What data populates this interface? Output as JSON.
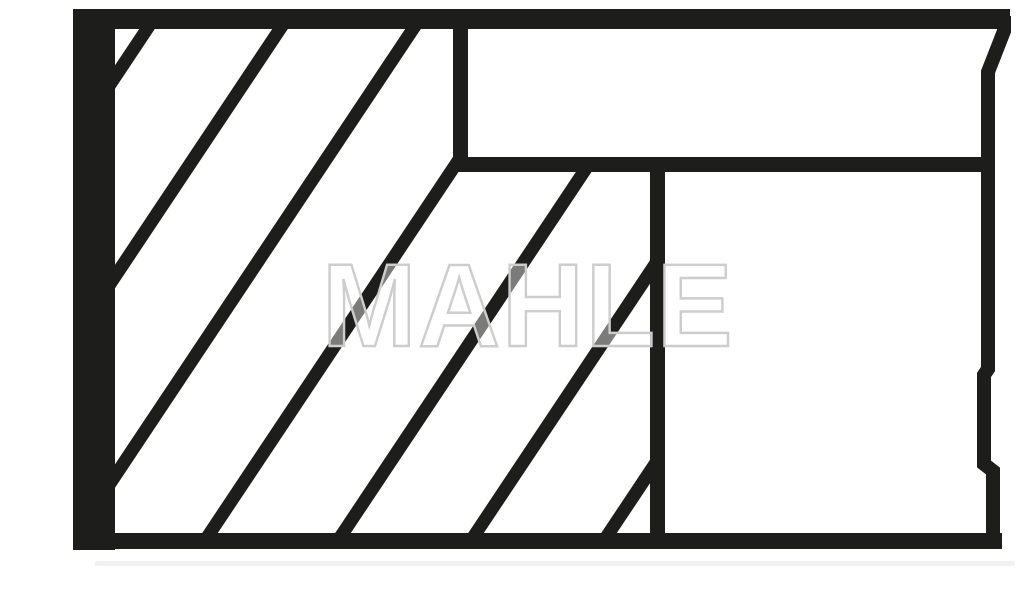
{
  "image": {
    "title": "Piston ring set cross-section line drawing",
    "background_color": "#ffffff",
    "line_color": "#1d1d1b",
    "shadow_color": "#f0f0f0"
  },
  "watermark": {
    "text": "MAHLE",
    "outline_color": "#cdcdcd",
    "fill_color": "rgba(255,255,255,0.42)"
  },
  "drawing": {
    "canvas": {
      "width": 1024,
      "height": 606
    },
    "bars": [
      {
        "name": "top-border",
        "x": 73,
        "y": 9,
        "w": 937,
        "h": 20
      },
      {
        "name": "left-border",
        "x": 73,
        "y": 9,
        "w": 42,
        "h": 541
      },
      {
        "name": "bottom-border",
        "x": 73,
        "y": 533,
        "w": 929,
        "h": 16
      },
      {
        "name": "groove-divider-horizontal",
        "x": 453,
        "y": 157,
        "w": 537,
        "h": 15
      },
      {
        "name": "groove-divider-vertical-top",
        "x": 453,
        "y": 29,
        "w": 15,
        "h": 143
      },
      {
        "name": "groove-divider-vertical-low",
        "x": 650,
        "y": 172,
        "w": 15,
        "h": 361
      }
    ],
    "right_edge_profile": {
      "stroke_width": 14,
      "points": [
        [
          1004,
          16
        ],
        [
          1004,
          31
        ],
        [
          988,
          72
        ],
        [
          988,
          369
        ],
        [
          984,
          375
        ],
        [
          984,
          464
        ],
        [
          993,
          471
        ],
        [
          993,
          541
        ]
      ]
    },
    "hatch": {
      "slope": 1.5,
      "stroke_width": 13,
      "bottom_y": 533,
      "top_y": 29,
      "feet_x": [
        -189,
        -56,
        77,
        210,
        343,
        476,
        609
      ],
      "clip_region": [
        [
          115,
          29
        ],
        [
          453,
          29
        ],
        [
          453,
          172
        ],
        [
          650,
          172
        ],
        [
          650,
          533
        ],
        [
          115,
          533
        ]
      ]
    },
    "under_shadow": {
      "x": 95,
      "y": 561,
      "w": 920,
      "h": 5
    }
  }
}
